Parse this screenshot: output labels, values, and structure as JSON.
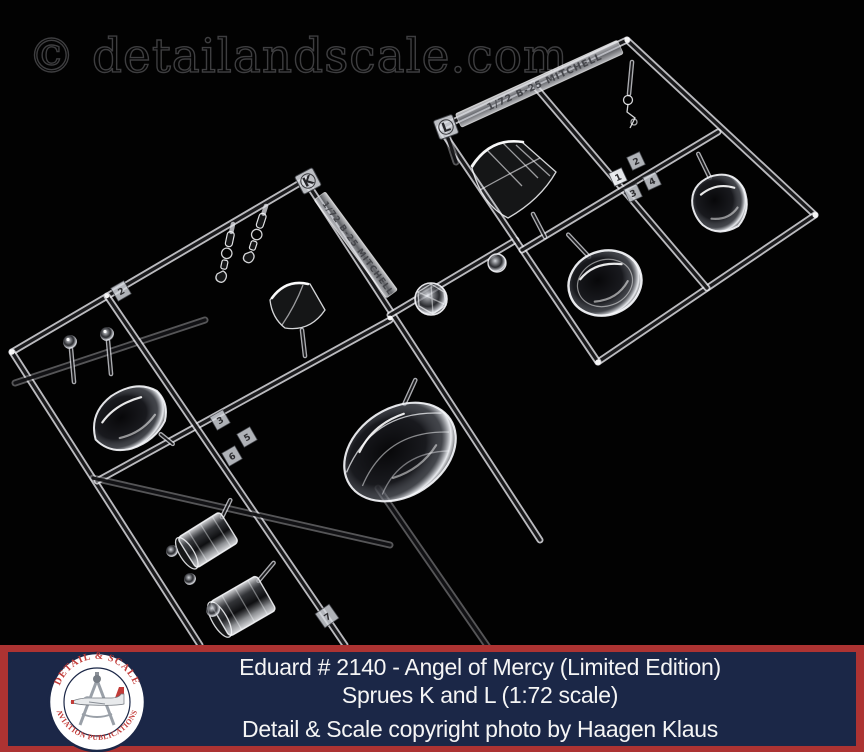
{
  "watermark": "© detailandscale.com",
  "sprue_k": {
    "label": "K",
    "molding_text": "1/72 B-25 MITCHELL",
    "part_numbers": [
      "2",
      "3",
      "5",
      "6",
      "7"
    ]
  },
  "sprue_l": {
    "label": "L",
    "molding_text": "1/72 B-25 MITCHELL",
    "part_numbers": [
      "1",
      "2",
      "3",
      "4"
    ]
  },
  "caption": {
    "line1": "Eduard # 2140 - Angel of Mercy (Limited Edition)",
    "line2": "Sprues K and L (1:72 scale)",
    "line3": "Detail & Scale copyright photo by Haagen Klaus"
  },
  "logo": {
    "arc_top": "DETAIL & SCALE",
    "arc_bottom": "AVIATION PUBLICATIONS"
  },
  "colors": {
    "background": "#000000",
    "caption_panel": "#1B2747",
    "caption_frame": "#AD3332",
    "caption_text": "#F5F5F5",
    "logo_red": "#C23B38",
    "logo_navy": "#1B2747",
    "watermark_gray": "#3E3E40"
  }
}
